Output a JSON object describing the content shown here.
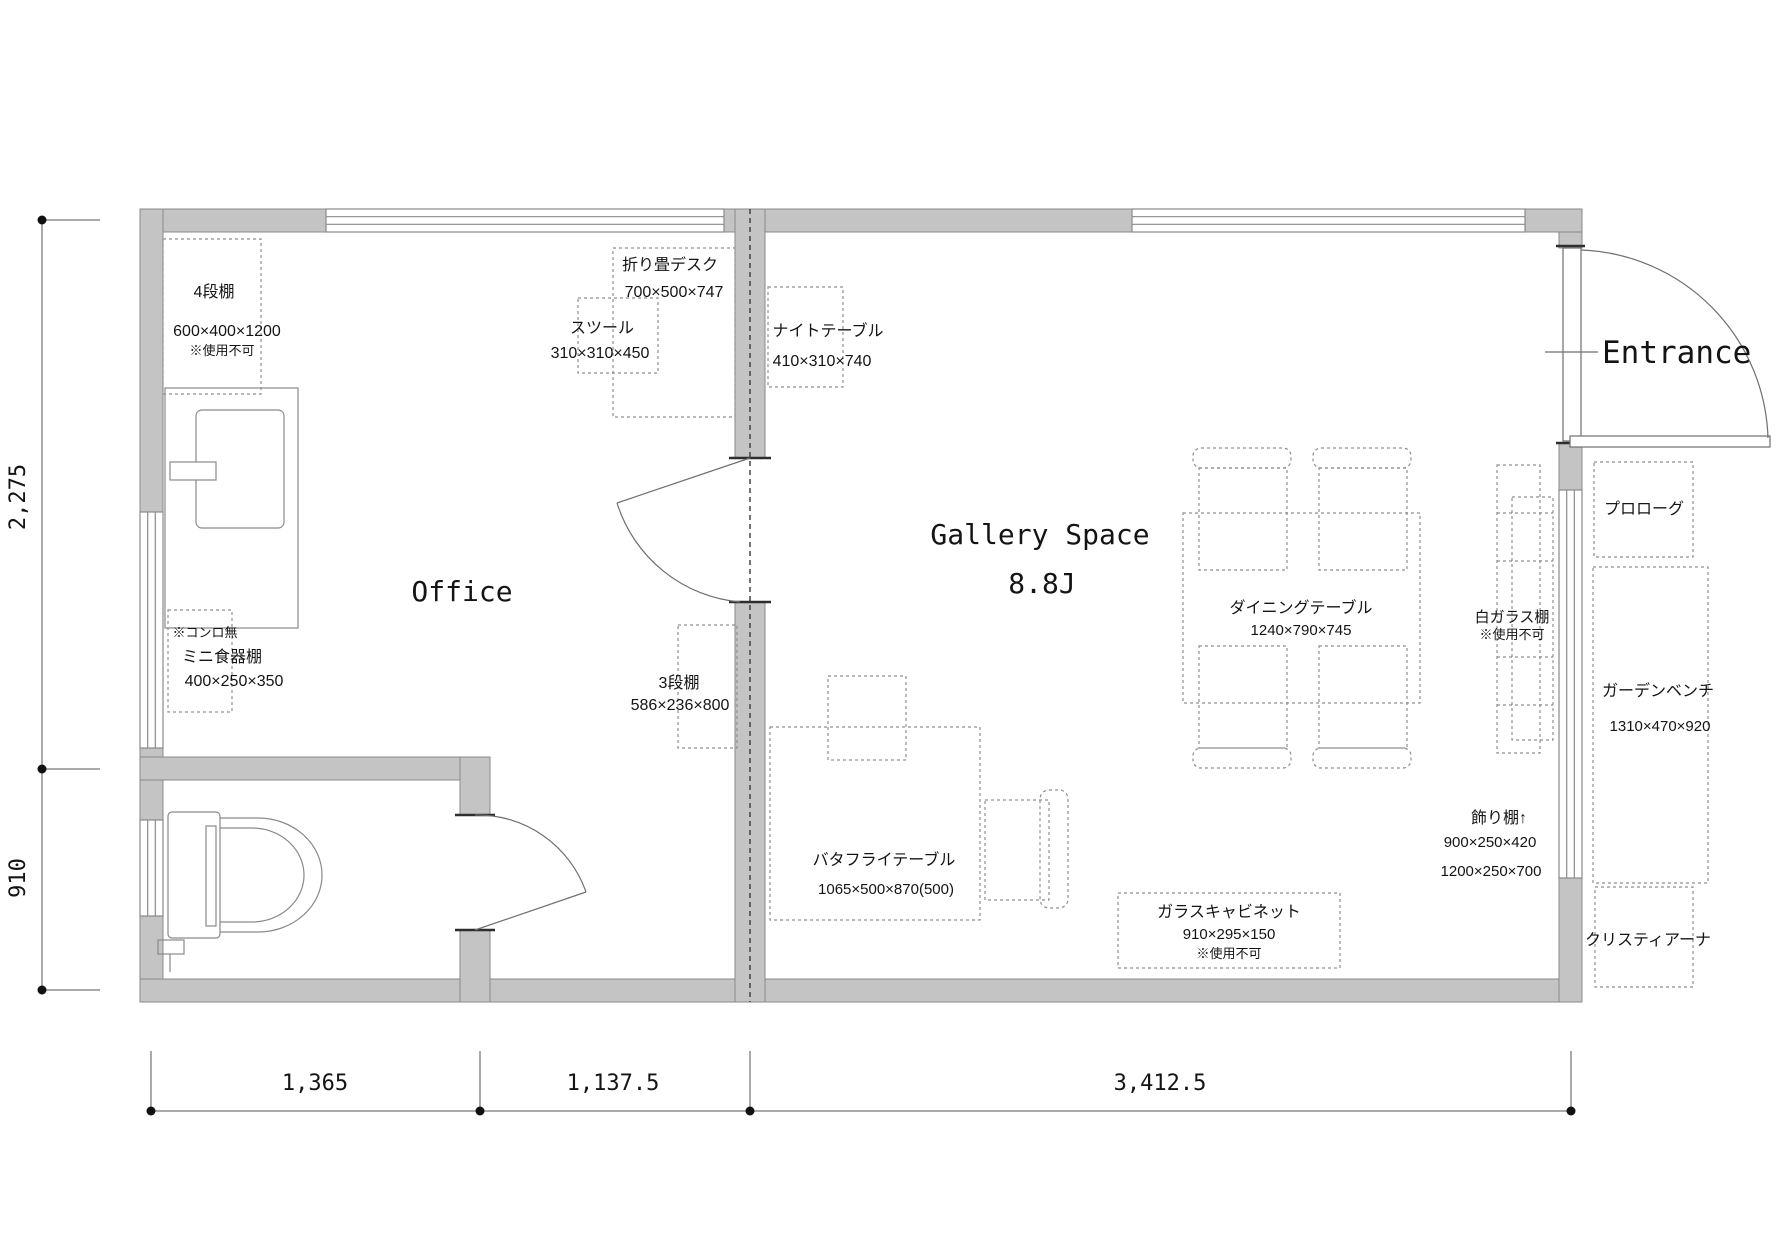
{
  "plan": {
    "rooms": {
      "office": {
        "label": "Office"
      },
      "gallery": {
        "label": "Gallery Space",
        "size_label": "8.8J"
      },
      "entrance": {
        "label": "Entrance"
      }
    },
    "furniture": {
      "shelf4": {
        "name": "4段棚",
        "dims": "600×400×1200",
        "note": "※使用不可"
      },
      "folding_desk": {
        "name": "折り畳デスク",
        "dims": "700×500×747"
      },
      "stool": {
        "name": "スツール",
        "dims": "310×310×450"
      },
      "night_table": {
        "name": "ナイトテーブル",
        "dims": "410×310×740"
      },
      "mini_cupboard": {
        "name": "ミニ食器棚",
        "dims": "400×250×350",
        "note": "※コンロ無"
      },
      "shelf3": {
        "name": "3段棚",
        "dims": "586×236×800"
      },
      "butterfly_table": {
        "name": "バタフライテーブル",
        "dims": "1065×500×870(500)"
      },
      "dining_table": {
        "name": "ダイニングテーブル",
        "dims": "1240×790×745"
      },
      "white_glass_shelf": {
        "name": "白ガラス棚",
        "note": "※使用不可"
      },
      "display_shelf": {
        "name": "飾り棚↑",
        "dims1": "900×250×420",
        "dims2": "1200×250×700"
      },
      "glass_cabinet": {
        "name": "ガラスキャビネット",
        "dims": "910×295×150",
        "note": "※使用不可"
      },
      "prologue": {
        "name": "プロローグ"
      },
      "garden_bench": {
        "name": "ガーデンベンチ",
        "dims": "1310×470×920"
      },
      "christiana": {
        "name": "クリスティアーナ"
      }
    },
    "dimensions": {
      "left_top": "2,275",
      "left_bottom": "910",
      "bottom_1": "1,365",
      "bottom_2": "1,137.5",
      "bottom_3": "3,412.5"
    },
    "colors": {
      "wall_fill": "#c4c4c4",
      "wall_line": "#8a8a8a",
      "dash_line": "#8f8f8f",
      "text": "#141414"
    }
  }
}
